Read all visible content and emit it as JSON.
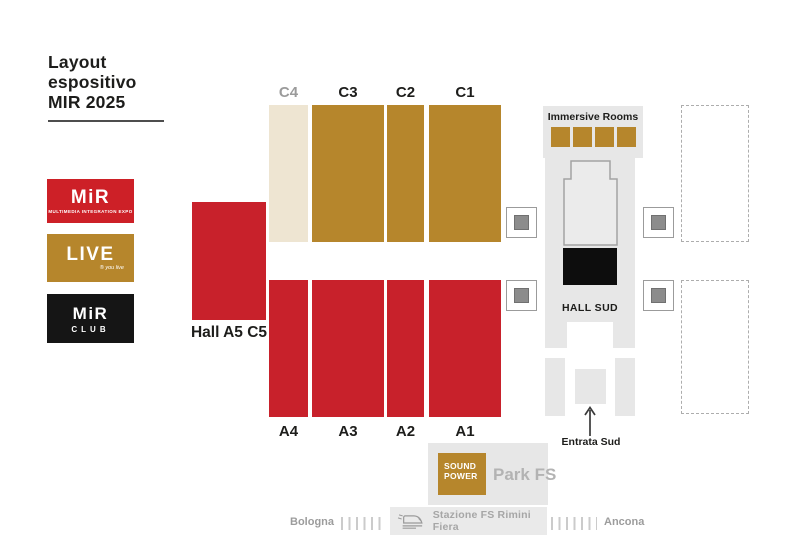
{
  "title": {
    "line1": "Layout",
    "line2": "espositivo",
    "line3": "MIR 2025"
  },
  "logos": {
    "mir": {
      "name": "MiR",
      "tagline": "MULTIMEDIA INTEGRATION EXPO"
    },
    "live": {
      "name": "LIVE",
      "tagline": "® you live"
    },
    "club": {
      "name": "MiR",
      "tagline": "CLUB"
    }
  },
  "halls": {
    "c_row": [
      {
        "id": "c4",
        "label": "C4"
      },
      {
        "id": "c3",
        "label": "C3"
      },
      {
        "id": "c2",
        "label": "C2"
      },
      {
        "id": "c1",
        "label": "C1"
      }
    ],
    "a_row": [
      {
        "id": "a4",
        "label": "A4"
      },
      {
        "id": "a3",
        "label": "A3"
      },
      {
        "id": "a2",
        "label": "A2"
      },
      {
        "id": "a1",
        "label": "A1"
      }
    ],
    "a5c5_label": "Hall A5 C5"
  },
  "south": {
    "immersive_label": "Immersive Rooms",
    "immersive_room_count": 4,
    "hall_sud_label": "HALL SUD",
    "entrata_label": "Entrata Sud"
  },
  "park": {
    "sound_line1": "SOUND",
    "sound_line2": "POWER",
    "label": "Park FS"
  },
  "railway": {
    "west": "Bologna",
    "east": "Ancona",
    "station": "Stazione FS Rimini Fiera"
  },
  "colors": {
    "red": "#c8212b",
    "gold": "#b6862c",
    "beige": "#eee5d2",
    "light_gray": "#e7e7e7",
    "black": "#0d0d0d",
    "text_gray": "#9b9b9b"
  }
}
